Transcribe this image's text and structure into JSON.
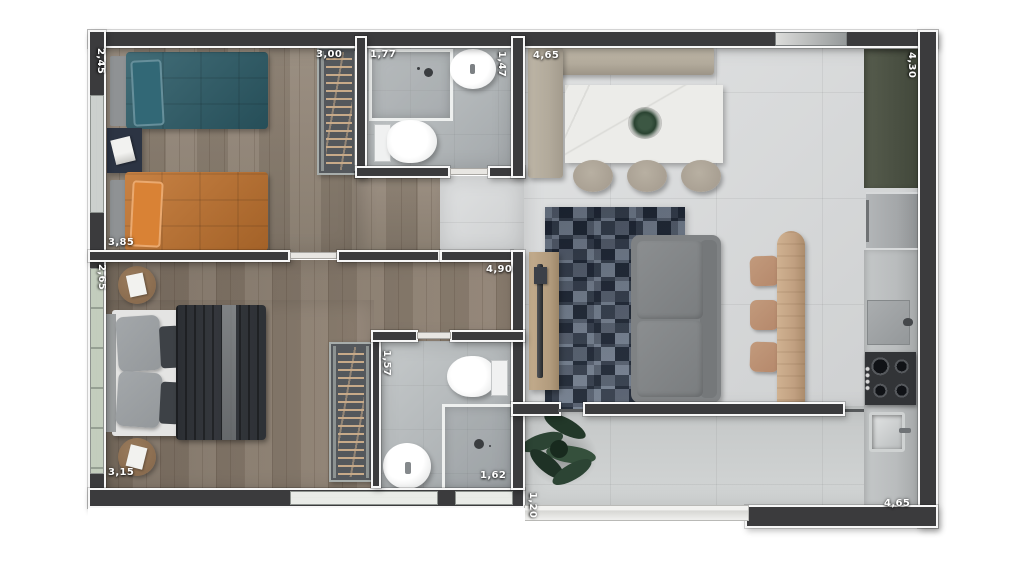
{
  "floorplan": {
    "title": "apartment-floor-plan",
    "unit": "m",
    "dimensions": {
      "bedroom1_side": "2,45",
      "bedroom1_top": "3,00",
      "bathroom1_top": "1,77",
      "bathroom1_side": "1,47",
      "living_top": "4,65",
      "kitchen_side_top": "4,30",
      "bedroom1_bottom": "3,85",
      "bedroom2_side_top": "2,65",
      "bedroom2_top": "4,90",
      "bathroom2_side": "1,57",
      "bedroom2_bottom": "3,15",
      "bathroom2_shower": "1,62",
      "terrace_side": "1,20",
      "kitchen_side_bottom": "4,65"
    },
    "colors": {
      "wall": "#3b3b3d",
      "wall-edge": "#f7f7f7",
      "wood-a": "#908374",
      "wood-b": "#8b7d6e",
      "tile": "#d6d8d9",
      "tile-terrace": "#cfd2d2",
      "bath-floor": "#b7bcbe",
      "bed-teal": "#2d5d69",
      "bed-orange": "#c2742f",
      "nightstand": "#2c3443",
      "headboard": "#8f9294",
      "duvet-dark": "#34373c",
      "pillow-gray": "#94989b",
      "bed-base": "#e4e4e3",
      "side-table": "#8a6c4f",
      "wardrobe": "#54585c",
      "hanger-wood": "#c7aa89",
      "bench": "#b2aa9b",
      "marble": "#ecece9",
      "stool": "#a9a093",
      "rug": "#4b5667",
      "sofa": "#7f8284",
      "tv-console": "#b29b7d",
      "desk-wood": "#c1a081",
      "chair-wood": "#b5886b",
      "counter-green": "#4b5143",
      "fridge": "#a4a7a9",
      "counter": "#b9bcbd",
      "cooktop": "#323437",
      "plant": "#2c4434",
      "window-green": "#c3cdbd",
      "window-gray": "#ccd0cd"
    }
  }
}
